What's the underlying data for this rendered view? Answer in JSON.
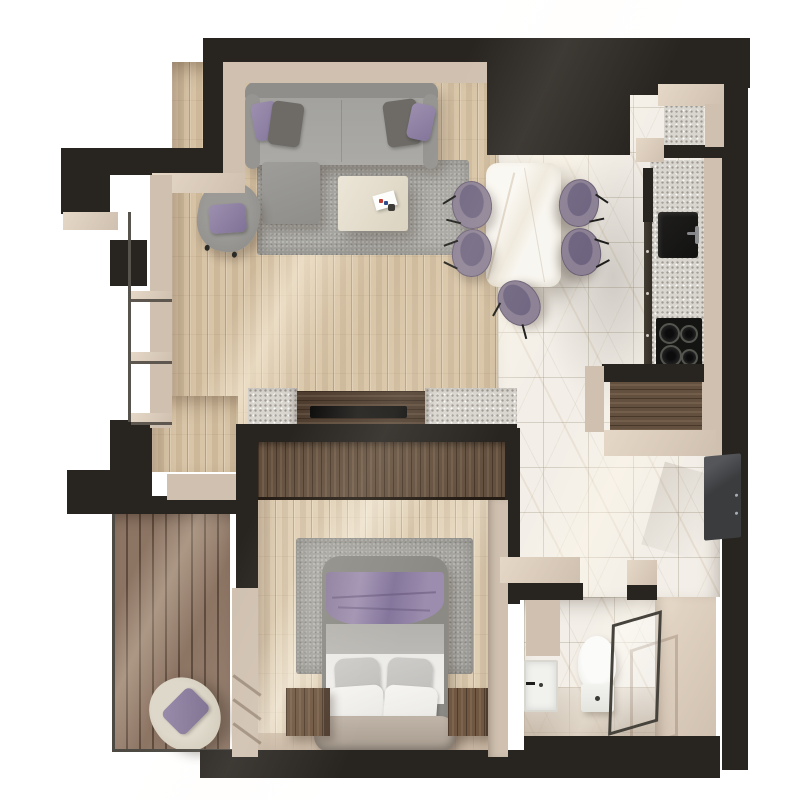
{
  "scene": {
    "title": "One-bedroom apartment — 3D top-down floor plan render",
    "background": "#ffffff",
    "lighting": "sunlight entering diagonally from upper-left, casting cream streaks across floors"
  },
  "palette": {
    "wall": "#282420",
    "wallFace": "#cfc0b0",
    "wallFaceLight": "#e6d8c7",
    "woodFloor": "#d8c4a6",
    "marble": "#f3efe8",
    "deck": "#8d7564",
    "deckSeam": "#5e4b3d",
    "walnut": "#64503e",
    "granite": "#d9d6d0",
    "sofaGray": "#9c9b97",
    "rugGray": "#a8a7a2",
    "purple": "#8b8094",
    "purpleDeep": "#6e6480",
    "blanketPurple": "#9083a4",
    "pillowDark": "#6e6b67",
    "cream": "#f2f1ee",
    "applianceBlack": "#151513",
    "glassFrame": "#46433d"
  },
  "counts": {
    "dining_chairs": 5,
    "cooktop_burners": 4,
    "bed_pillows": 4,
    "nightstands": 2,
    "sofa_throw_pillows": 4,
    "window_shelves": 3
  },
  "rooms": [
    {
      "id": "living-room",
      "label": "Living room",
      "floor": "light oak plank",
      "items": [
        "sectional sofa",
        "chaise ottoman",
        "throw pillows (2 purple, 2 dark gray)",
        "coffee table with magazine",
        "armchair with purple cushion",
        "gray area rug",
        "TV console flanked by granite blocks",
        "flat TV"
      ]
    },
    {
      "id": "dining-area",
      "label": "Dining area",
      "floor": "oak plank / marble tile",
      "items": [
        "white marble dining table",
        "5 purple upholstered chairs"
      ]
    },
    {
      "id": "kitchen",
      "label": "Kitchen",
      "floor": "marble tile",
      "items": [
        "granite counter run",
        "black undermount sink",
        "mixer tap",
        "4-burner black cooktop",
        "two granite counter niches",
        "dark upper cabinet block"
      ]
    },
    {
      "id": "entry-hall",
      "label": "Entry hall",
      "floor": "marble tile",
      "items": [
        "walnut entry closet",
        "dark entry door"
      ]
    },
    {
      "id": "bedroom",
      "label": "Bedroom",
      "floor": "light oak plank",
      "items": [
        "double bed with purple blanket",
        "gray and white pillows",
        "2 walnut nightstands",
        "walnut wardrobe",
        "gray area rug"
      ]
    },
    {
      "id": "bathroom",
      "label": "Bathroom",
      "floor": "marble tile",
      "items": [
        "washbasin",
        "toilet",
        "glass shower screen"
      ]
    },
    {
      "id": "balcony",
      "label": "Balcony",
      "floor": "dark hardwood decking",
      "items": [
        "cream lounge chair with purple cushion",
        "glass railing"
      ]
    }
  ]
}
